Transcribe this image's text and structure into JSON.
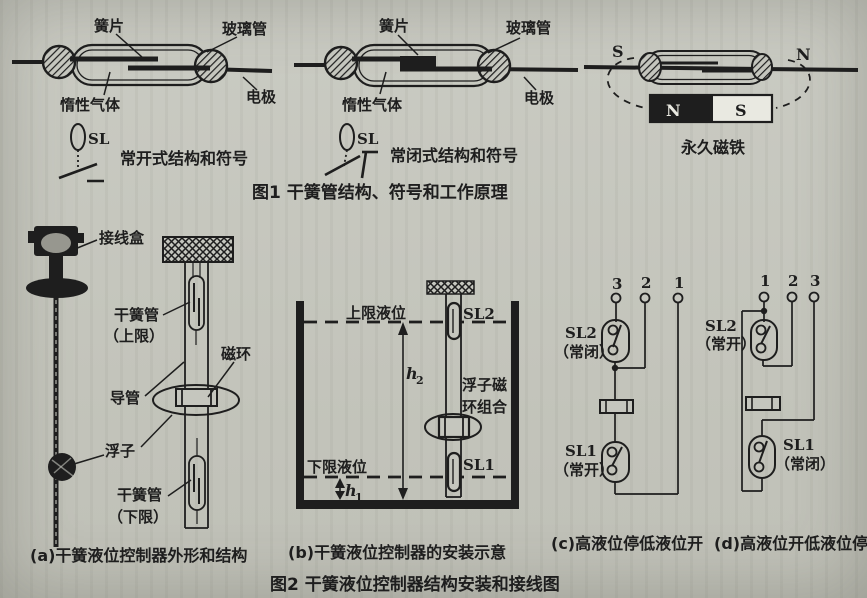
{
  "colors": {
    "paper": "#c5c6be",
    "ink": "#1e1e1e"
  },
  "figure1": {
    "caption": "图1  干簧管结构、符号和工作原理",
    "open": {
      "reed": "簧片",
      "glass": "玻璃管",
      "gas": "惰性气体",
      "electrode": "电极",
      "sl": "SL",
      "label": "常开式结构和符号"
    },
    "closed": {
      "reed": "簧片",
      "glass": "玻璃管",
      "gas": "惰性气体",
      "electrode": "电极",
      "sl": "SL",
      "label": "常闭式结构和符号"
    },
    "magnet": {
      "pole_left": "S",
      "pole_right": "N",
      "pole_n": "N",
      "pole_s": "S",
      "label": "永久磁铁"
    }
  },
  "figure2": {
    "caption": "图2  干簧液位控制器结构安装和接线图",
    "panel_a": {
      "caption": "(a)干簧液位控制器外形和结构",
      "junction_box": "接线盒",
      "reed_upper": "干簧管",
      "reed_upper_limit": "（上限）",
      "magnet_ring": "磁环",
      "guide_tube": "导管",
      "float_label": "浮子",
      "reed_lower": "干簧管",
      "reed_lower_limit": "（下限）"
    },
    "panel_b": {
      "caption": "(b)干簧液位控制器的安装示意",
      "upper_level": "上限液位",
      "lower_level": "下限液位",
      "sl2": "SL2",
      "sl1": "SL1",
      "h_var": "h",
      "h2_sub": "2",
      "h1_sub": "1",
      "float_ring_line1": "浮子磁",
      "float_ring_line2": "环组合"
    },
    "panel_c": {
      "caption": "(c)高液位停低液位开",
      "terminals": [
        "3",
        "2",
        "1"
      ],
      "sl2": "SL2",
      "sl2_state": "（常闭）",
      "sl1": "SL1",
      "sl1_state": "（常开）"
    },
    "panel_d": {
      "caption": "(d)高液位开低液位停",
      "terminals": [
        "1",
        "2",
        "3"
      ],
      "sl2": "SL2",
      "sl2_state": "（常开）",
      "sl1": "SL1",
      "sl1_state": "（常闭）"
    }
  }
}
